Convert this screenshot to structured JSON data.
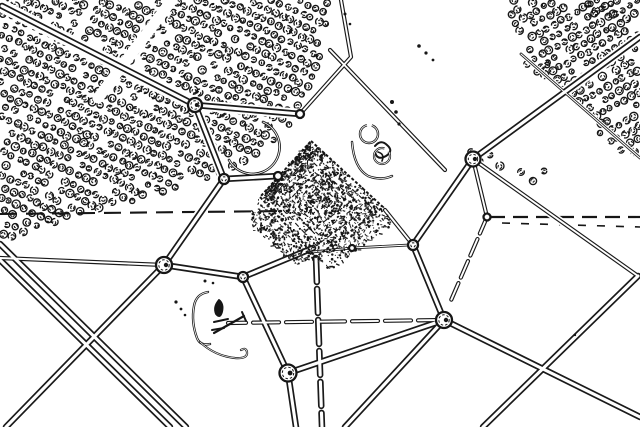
{
  "image": {
    "width": 640,
    "height": 427
  },
  "palette": {
    "background": "#ffffff",
    "ink": "#161616",
    "ink_soft": "#3a3a3a",
    "road": "#1a1a1a"
  },
  "orchards": [
    {
      "name": "top-left-orchard",
      "polygon": [
        [
          0,
          0
        ],
        [
          332,
          0
        ],
        [
          326,
          40
        ],
        [
          308,
          90
        ],
        [
          296,
          120
        ],
        [
          240,
          170
        ],
        [
          150,
          196
        ],
        [
          0,
          240
        ]
      ],
      "row_angle_deg": 25,
      "row_spacing": 10.5,
      "tree_step": 8.5,
      "seed": 7
    },
    {
      "name": "top-right-orchard",
      "polygon": [
        [
          504,
          0
        ],
        [
          640,
          0
        ],
        [
          640,
          160
        ],
        [
          522,
          56
        ]
      ],
      "row_angle_deg": -29,
      "row_spacing": 10,
      "tree_step": 8.3,
      "seed": 11
    }
  ],
  "tree_clumps": [
    [
      471,
      152
    ],
    [
      479,
      161
    ],
    [
      490,
      155
    ],
    [
      500,
      166
    ],
    [
      521,
      172
    ],
    [
      533,
      181
    ],
    [
      544,
      171
    ],
    [
      527,
      64
    ],
    [
      537,
      72
    ],
    [
      547,
      65
    ],
    [
      588,
      4
    ],
    [
      596,
      11
    ],
    [
      605,
      6
    ],
    [
      613,
      14
    ],
    [
      600,
      133
    ],
    [
      611,
      141
    ],
    [
      621,
      150
    ]
  ],
  "clearings": [
    {
      "from": [
        172,
        0
      ],
      "to": [
        98,
        98
      ],
      "width": 11
    }
  ],
  "pyramid": {
    "corners": [
      [
        311,
        141
      ],
      [
        383,
        207
      ],
      [
        316,
        257
      ],
      [
        260,
        197
      ]
    ],
    "center": [
      318,
      200
    ],
    "ring_scales": [
      1,
      0.8,
      0.63,
      0.47,
      0.32,
      0.2
    ],
    "noise_count": 950,
    "seed": 13,
    "spill_patches": [
      {
        "polygon": [
          [
            258,
            200
          ],
          [
            316,
            258
          ],
          [
            298,
            266
          ],
          [
            250,
            226
          ]
        ],
        "count": 240,
        "seed": 3
      },
      {
        "polygon": [
          [
            316,
            258
          ],
          [
            383,
            207
          ],
          [
            393,
            224
          ],
          [
            330,
            270
          ]
        ],
        "count": 190,
        "seed": 5
      },
      {
        "polygon": [
          [
            262,
            196
          ],
          [
            311,
            141
          ],
          [
            318,
            152
          ],
          [
            272,
            206
          ]
        ],
        "count": 170,
        "seed": 9
      }
    ]
  },
  "roads": {
    "style": {
      "major": {
        "outer": 6.5,
        "inner": 3.1,
        "casing": 10.5
      },
      "thin": {
        "outer": 4.2,
        "inner": 1.9,
        "casing": 7.5
      },
      "hair": {
        "outer": 2.8,
        "inner": 1.1,
        "casing": 5
      }
    },
    "segments": [
      {
        "pts": [
          [
            2,
            6
          ],
          [
            195,
            105
          ]
        ],
        "kind": "major",
        "casing": 13
      },
      {
        "pts": [
          [
            195,
            105
          ],
          [
            300,
            114
          ]
        ],
        "kind": "major"
      },
      {
        "pts": [
          [
            300,
            114
          ],
          [
            351,
            57
          ],
          [
            341,
            0
          ]
        ],
        "kind": "thin"
      },
      {
        "pts": [
          [
            195,
            105
          ],
          [
            224,
            179
          ]
        ],
        "kind": "major"
      },
      {
        "pts": [
          [
            224,
            179
          ],
          [
            278,
            176
          ]
        ],
        "kind": "major"
      },
      {
        "pts": [
          [
            224,
            179
          ],
          [
            164,
            265
          ]
        ],
        "kind": "major"
      },
      {
        "pts": [
          [
            164,
            265
          ],
          [
            6,
            427
          ]
        ],
        "kind": "major"
      },
      {
        "pts": [
          [
            164,
            265
          ],
          [
            0,
            258
          ]
        ],
        "kind": "thin"
      },
      {
        "pts": [
          [
            164,
            265
          ],
          [
            243,
            277
          ]
        ],
        "kind": "major"
      },
      {
        "pts": [
          [
            243,
            277
          ],
          [
            313,
            248
          ]
        ],
        "kind": "major"
      },
      {
        "pts": [
          [
            243,
            277
          ],
          [
            288,
            373
          ]
        ],
        "kind": "major"
      },
      {
        "pts": [
          [
            288,
            373
          ],
          [
            296,
            427
          ]
        ],
        "kind": "major"
      },
      {
        "pts": [
          [
            288,
            373
          ],
          [
            444,
            320
          ]
        ],
        "kind": "major"
      },
      {
        "pts": [
          [
            444,
            320
          ],
          [
            345,
            427
          ]
        ],
        "kind": "major"
      },
      {
        "pts": [
          [
            444,
            320
          ],
          [
            640,
            417
          ]
        ],
        "kind": "major"
      },
      {
        "pts": [
          [
            444,
            320
          ],
          [
            228,
            323
          ]
        ],
        "kind": "thin",
        "dash": "26 7"
      },
      {
        "pts": [
          [
            413,
            245
          ],
          [
            444,
            320
          ]
        ],
        "kind": "major"
      },
      {
        "pts": [
          [
            413,
            245
          ],
          [
            473,
            159
          ]
        ],
        "kind": "major"
      },
      {
        "pts": [
          [
            413,
            245
          ],
          [
            385,
            210
          ]
        ],
        "kind": "thin"
      },
      {
        "pts": [
          [
            312,
            252
          ],
          [
            352,
            248
          ],
          [
            409,
            245
          ]
        ],
        "kind": "hair"
      },
      {
        "pts": [
          [
            473,
            159
          ],
          [
            640,
            37
          ]
        ],
        "kind": "major"
      },
      {
        "pts": [
          [
            473,
            159
          ],
          [
            638,
            276
          ]
        ],
        "kind": "thin"
      },
      {
        "pts": [
          [
            638,
            276
          ],
          [
            483,
            427
          ]
        ],
        "kind": "major"
      },
      {
        "pts": [
          [
            473,
            159
          ],
          [
            487,
            217
          ]
        ],
        "kind": "thin"
      },
      {
        "pts": [
          [
            487,
            217
          ],
          [
            449,
            305
          ]
        ],
        "kind": "thin",
        "dash": "18 6"
      },
      {
        "pts": [
          [
            330,
            50
          ],
          [
            445,
            170
          ]
        ],
        "kind": "thin"
      },
      {
        "pts": [
          [
            316,
            258
          ],
          [
            322,
            427
          ]
        ],
        "kind": "major",
        "dash": "24 7"
      },
      {
        "pts": [
          [
            521,
            54
          ],
          [
            640,
            158
          ]
        ],
        "kind": "hair"
      },
      {
        "pts": [
          [
            0,
            244
          ],
          [
            186,
            427
          ]
        ],
        "kind": "major"
      },
      {
        "pts": [
          [
            0,
            260
          ],
          [
            170,
            427
          ]
        ],
        "kind": "major"
      }
    ]
  },
  "field_lines": [
    {
      "pts": [
        [
          0,
          214
        ],
        [
          288,
          211
        ]
      ],
      "width": 2.1,
      "dash": "17 9"
    },
    {
      "pts": [
        [
          490,
          217
        ],
        [
          640,
          217
        ]
      ],
      "width": 2.2,
      "dash": "15 8"
    },
    {
      "pts": [
        [
          502,
          223
        ],
        [
          640,
          227
        ]
      ],
      "width": 1.6,
      "dash": "8 11"
    }
  ],
  "nodes": [
    {
      "c": [
        195,
        105
      ],
      "r": 7
    },
    {
      "c": [
        300,
        114
      ],
      "r": 4
    },
    {
      "c": [
        224,
        179
      ],
      "r": 5
    },
    {
      "c": [
        278,
        176
      ],
      "r": 4
    },
    {
      "c": [
        473,
        159
      ],
      "r": 7.5
    },
    {
      "c": [
        413,
        245
      ],
      "r": 5
    },
    {
      "c": [
        444,
        320
      ],
      "r": 8
    },
    {
      "c": [
        164,
        265
      ],
      "r": 8
    },
    {
      "c": [
        243,
        277
      ],
      "r": 5
    },
    {
      "c": [
        288,
        373
      ],
      "r": 8.5
    },
    {
      "c": [
        487,
        217
      ],
      "r": 3.5
    },
    {
      "c": [
        352,
        248
      ],
      "r": 3
    }
  ],
  "scribbles": [
    {
      "d": "M229 160 A27 27 0 1 0 263 122",
      "w": 2.6,
      "twin": true
    },
    {
      "d": "M352 142 Q354 168 368 176 Q381 181 392 176",
      "w": 2.4,
      "twin": true
    },
    {
      "d": "M375 146 q6 -7 12 -1 q7 6 -1 11 q-9 5 -11 -4",
      "w": 2
    },
    {
      "d": "M378 152 q7 2 4 9",
      "w": 1.6
    },
    {
      "d": "M208 292 Q196 294 194 306 Q191 322 197 338 Q200 346 210 344",
      "w": 2.4,
      "twin": true
    },
    {
      "d": "M200 342 Q215 356 235 358 Q248 359 247 352 Q246 347 241 350",
      "w": 2.2,
      "twin": true
    },
    {
      "d": "M214 322 l14 -3",
      "w": 2
    },
    {
      "d": "M212 330 l12 -2",
      "w": 2
    },
    {
      "d": "M214 333 L244 316",
      "w": 2.2
    },
    {
      "d": "M242 312 l4 9",
      "w": 2
    },
    {
      "d": "M219 300 q5 4 3 12 q-2 7 -6 2 q-3 -7 3 -14",
      "w": 1.8,
      "fill": true
    }
  ],
  "rings": [
    {
      "c": [
        369,
        134
      ],
      "r": 9,
      "w": 2.4
    },
    {
      "c": [
        382,
        156
      ],
      "r": 8,
      "w": 2.2
    }
  ],
  "dots": [
    [
      176,
      302,
      1.6
    ],
    [
      181,
      309,
      1.4
    ],
    [
      185,
      315,
      1.3
    ],
    [
      205,
      281,
      1.5
    ],
    [
      213,
      283,
      1.3
    ],
    [
      392,
      102,
      2
    ],
    [
      396,
      112,
      1.8
    ],
    [
      399,
      124,
      1.6
    ],
    [
      419,
      46,
      1.8
    ],
    [
      426,
      53,
      1.6
    ],
    [
      433,
      60,
      1.4
    ],
    [
      575,
      335,
      1.2
    ],
    [
      345,
      14,
      1.5
    ],
    [
      350,
      24,
      1.3
    ]
  ]
}
